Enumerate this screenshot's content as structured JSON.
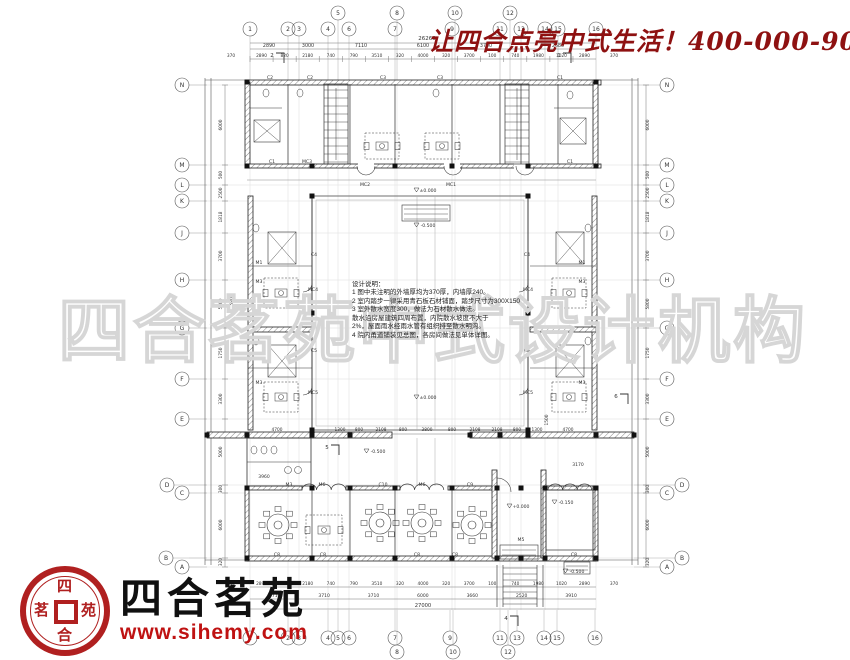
{
  "branding": {
    "slogan": "让四合点亮中式生活！400-000-9075",
    "logo_name": "四合茗苑",
    "website": "www.sihemy.com",
    "seal": {
      "top": "四",
      "bottom": "合",
      "left": "茗",
      "right": "苑"
    }
  },
  "watermark": "四合茗苑中式设计机构",
  "notes": {
    "title": "设计说明：",
    "lines": [
      "1 图中未注明的外墙厚均为370厚，内墙厚240。",
      "2 室内踏步一律采用青石板石材铺面，踏步尺寸为300X150",
      "3 室外散水宽度300，做法为石材散水做法。",
      "   散水沿房屋建筑四周布置，内院散水坡度不大于",
      "   2%，屋面雨水经雨水管有组织排至散水明沟。",
      "4 院内甬道铺装见总图，各房间做法见单体详图。"
    ]
  },
  "axes": {
    "top": [
      "1",
      "2",
      "3",
      "4",
      "5",
      "6",
      "7",
      "8",
      "9",
      "10",
      "11",
      "12",
      "13",
      "14",
      "15",
      "16"
    ],
    "bottom": [
      "1",
      "2",
      "3",
      "4",
      "5",
      "6",
      "7",
      "8",
      "9",
      "10",
      "11",
      "12",
      "13",
      "14",
      "15",
      "16"
    ],
    "left": [
      "N",
      "M",
      "L",
      "K",
      "J",
      "H",
      "G",
      "F",
      "E",
      "D",
      "C",
      "B",
      "A"
    ],
    "right": [
      "N",
      "M",
      "L",
      "K",
      "J",
      "H",
      "G",
      "F",
      "E",
      "D",
      "C",
      "B",
      "A"
    ]
  },
  "dims": {
    "top_total": "26260",
    "bottom_total": "27000",
    "top_coarse": [
      "2890",
      "3000",
      "7110",
      "6100",
      "3700",
      "2680"
    ],
    "axis_segments": [
      "2890",
      "820",
      "2180",
      "740",
      "790",
      "3510",
      "320",
      "4000",
      "320",
      "3700",
      "100",
      "740",
      "1980",
      "1020",
      "2890"
    ],
    "edge": "370",
    "bottom_row2": [
      "3710",
      "3710",
      "3710",
      "6000",
      "3660",
      "2520",
      "3910"
    ],
    "side_segments": [
      "6000",
      "500",
      "2500",
      "1818",
      "3700",
      "5800",
      "1750",
      "3300",
      "5000",
      "300",
      "6000",
      "320"
    ],
    "inner_row": [
      "4700",
      "1300",
      "800",
      "2108",
      "800",
      "3800",
      "800",
      "2108",
      "2108",
      "800",
      "1300",
      "4700"
    ],
    "misc": [
      "3170",
      "3960",
      "1500",
      "5800"
    ]
  },
  "tags": [
    "C2",
    "C2",
    "C3",
    "C3",
    "C1",
    "C1",
    "MC3",
    "MC2",
    "MC1",
    "C1",
    "C4",
    "M1",
    "M3",
    "MC4",
    "C5",
    "M3",
    "MC5",
    "C4",
    "MC4",
    "C5",
    "MC5",
    "M1",
    "M3",
    "M3",
    "M5",
    "M3",
    "M6",
    "C10",
    "M6",
    "C9",
    "C8",
    "C8",
    "C8",
    "C8",
    "C8"
  ],
  "elevations": [
    "±0.000",
    "-0.500",
    "±0.000",
    "-0.500",
    "+0.000",
    "-0.150",
    "-0.500"
  ],
  "sections": [
    "2",
    "1",
    "5",
    "4",
    "6"
  ],
  "colors": {
    "brand_red": "#8e1111",
    "seal_red": "#b02020",
    "web_red": "#bf1212",
    "ink": "#222222",
    "grid": "#c8c8c8",
    "watermark": "#d6d6d6"
  }
}
